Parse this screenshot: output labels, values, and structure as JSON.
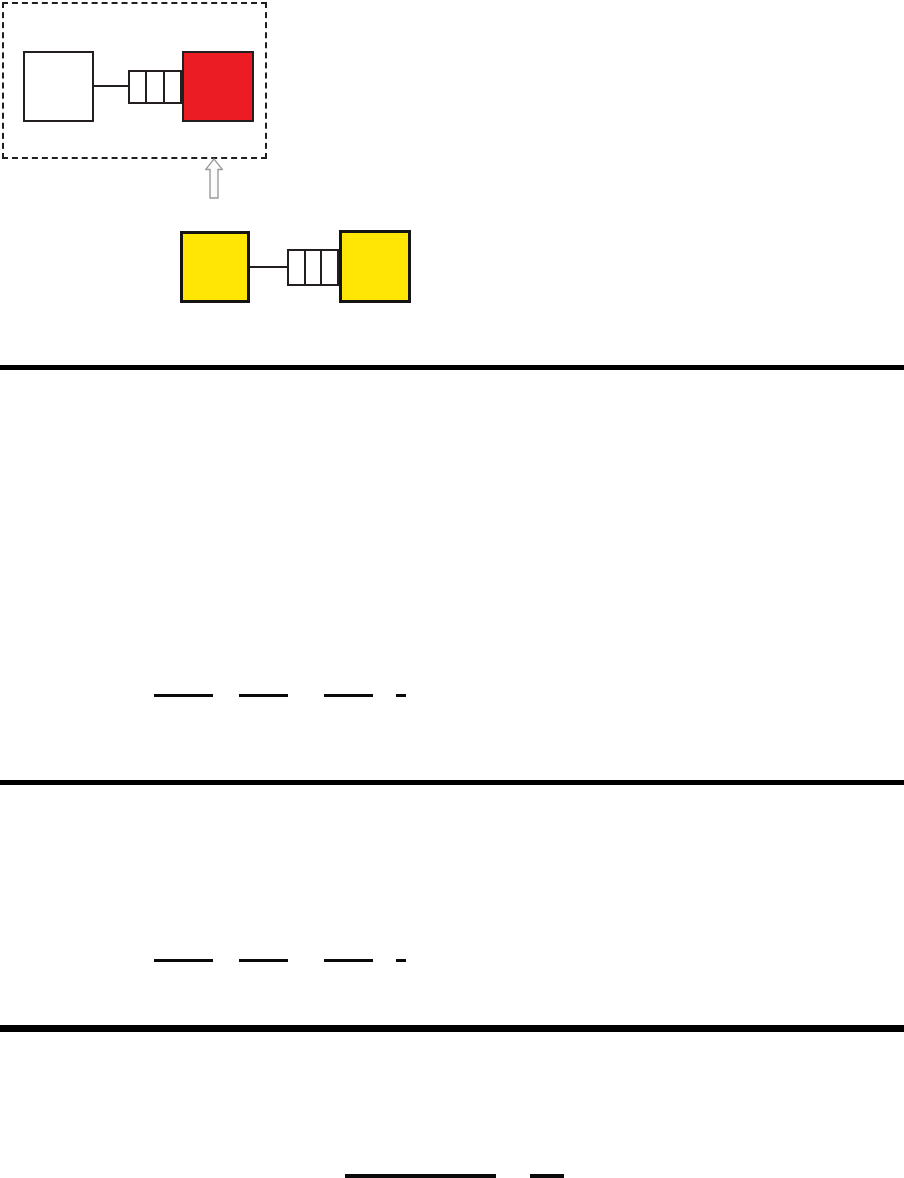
{
  "page": {
    "width": 904,
    "height": 1178,
    "background": "#FFFFFF",
    "description": "worksheet page with block-and-coupler diagrams, section rules and blank answer lines; no rendered text"
  },
  "figure": {
    "framed_pair": {
      "frame_style": "dashed",
      "left_block": {
        "label": "white-block",
        "fill": "#FFFFFF",
        "stroke": "#231F20"
      },
      "coupler": {
        "cells": 3,
        "fill": "#FFFFFF",
        "stroke": "#231F20"
      },
      "right_block": {
        "label": "red-block",
        "fill": "#EC1C24",
        "stroke": "#231F20"
      }
    },
    "arrow": {
      "direction": "up",
      "fill": "#FBFBFB",
      "stroke": "#9B9B9B"
    },
    "yellow_pair": {
      "left_block": {
        "label": "yellow-block",
        "fill": "#FFE605",
        "stroke": "#141414"
      },
      "coupler": {
        "cells": 3,
        "fill": "#FFFFFF",
        "stroke": "#231F20"
      },
      "right_block": {
        "label": "yellow-block",
        "fill": "#FFE605",
        "stroke": "#141414"
      }
    }
  },
  "sections": {
    "divider_color": "#000000",
    "dividers": [
      {
        "y": 365,
        "h": 5
      },
      {
        "y": 780,
        "h": 5
      },
      {
        "y": 1025,
        "h": 7
      }
    ],
    "blank_line_groups": [
      {
        "y": 694,
        "lines": [
          {
            "x": 154,
            "w": 59
          },
          {
            "x": 239,
            "w": 49
          },
          {
            "x": 324,
            "w": 49
          },
          {
            "x": 396,
            "w": 10
          }
        ]
      },
      {
        "y": 959,
        "lines": [
          {
            "x": 154,
            "w": 59
          },
          {
            "x": 239,
            "w": 49
          },
          {
            "x": 324,
            "w": 49
          },
          {
            "x": 396,
            "w": 10
          }
        ]
      }
    ],
    "bottom_lines_y": 1174,
    "bottom_lines": [
      {
        "x": 345,
        "w": 151
      },
      {
        "x": 530,
        "w": 34
      }
    ]
  }
}
